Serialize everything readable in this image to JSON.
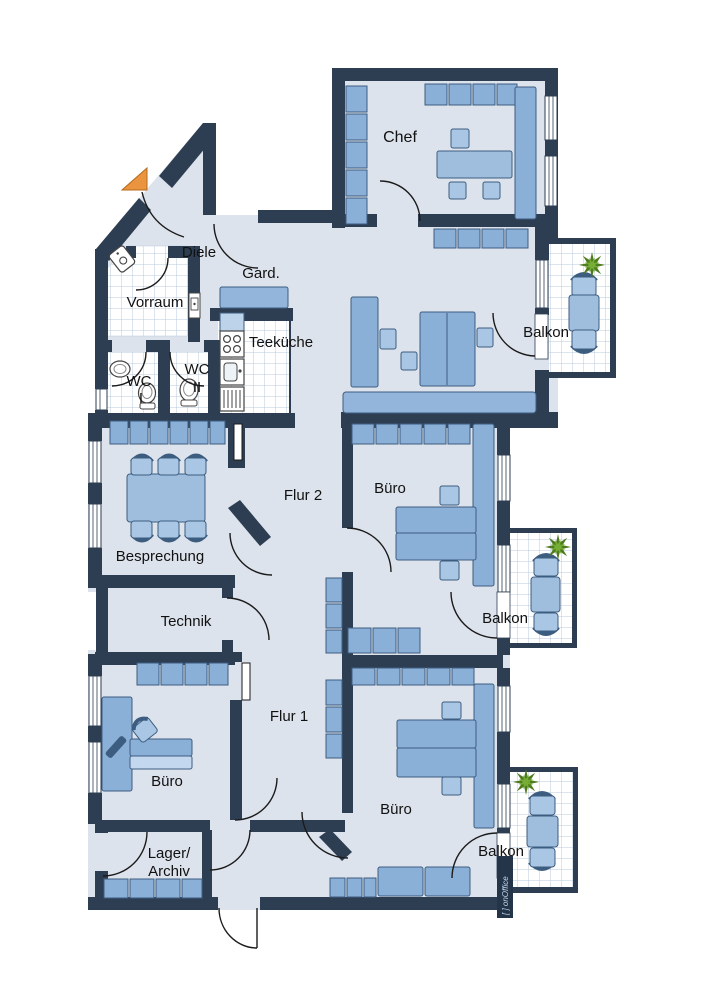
{
  "plan": {
    "rooms": {
      "chef": "Chef",
      "diele": "Diele",
      "gard": "Gard.",
      "vorraum": "Vorraum",
      "teekueche": "Teeküche",
      "wc1": {
        "l1": "WC",
        "l2": "I"
      },
      "wc2": {
        "l1": "WC",
        "l2": "II"
      },
      "balkon_top": "Balkon",
      "balkon_mid": "Balkon",
      "balkon_bottom": "Balkon",
      "besprechung": "Besprechung",
      "technik": "Technik",
      "flur1": "Flur 1",
      "flur2": "Flur 2",
      "buero_mid": "Büro",
      "buero_left": "Büro",
      "buero_bottom": "Büro",
      "lager": {
        "l1": "Lager/",
        "l2": "Archiv"
      }
    },
    "watermark": "[ ] onOffice",
    "colors": {
      "wall": "#2e3e52",
      "floor": "#dde3ec",
      "tile_line": "#b8cade",
      "furniture": "#8ab0d8",
      "furniture_dark": "#3d5d80",
      "furniture_light": "#a9c6e4",
      "accent_orange": "#ea9440",
      "plant_green": "#5c8f25"
    }
  }
}
